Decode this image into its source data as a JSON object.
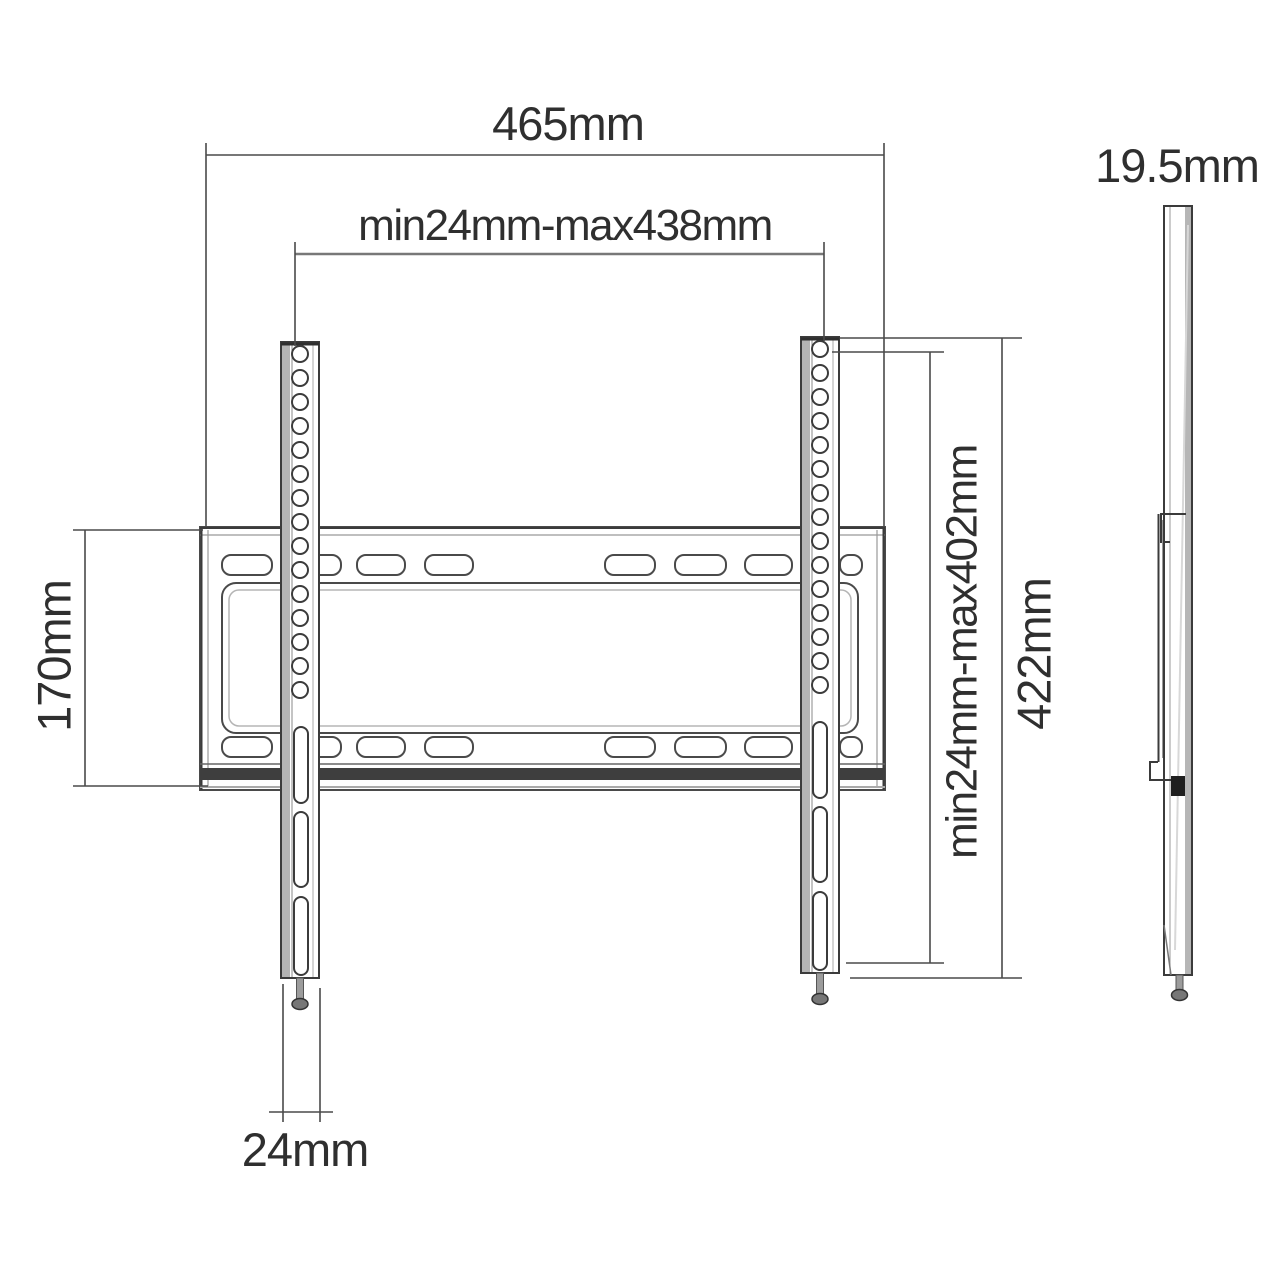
{
  "drawing": {
    "front_view": {
      "dim_total_width": "465mm",
      "dim_hole_span_width": "min24mm-max438mm",
      "dim_plate_height": "170mm",
      "dim_hole_span_height": "min24mm-max402mm",
      "dim_total_height": "422mm",
      "dim_arm_width": "24mm"
    },
    "side_view": {
      "dim_depth": "19.5mm"
    },
    "colors": {
      "line": "#3b3b3b",
      "dimension_line": "#4a4a4a",
      "text": "#2f2f2f",
      "shading": "#b4b4b4",
      "background": "#ffffff"
    }
  }
}
